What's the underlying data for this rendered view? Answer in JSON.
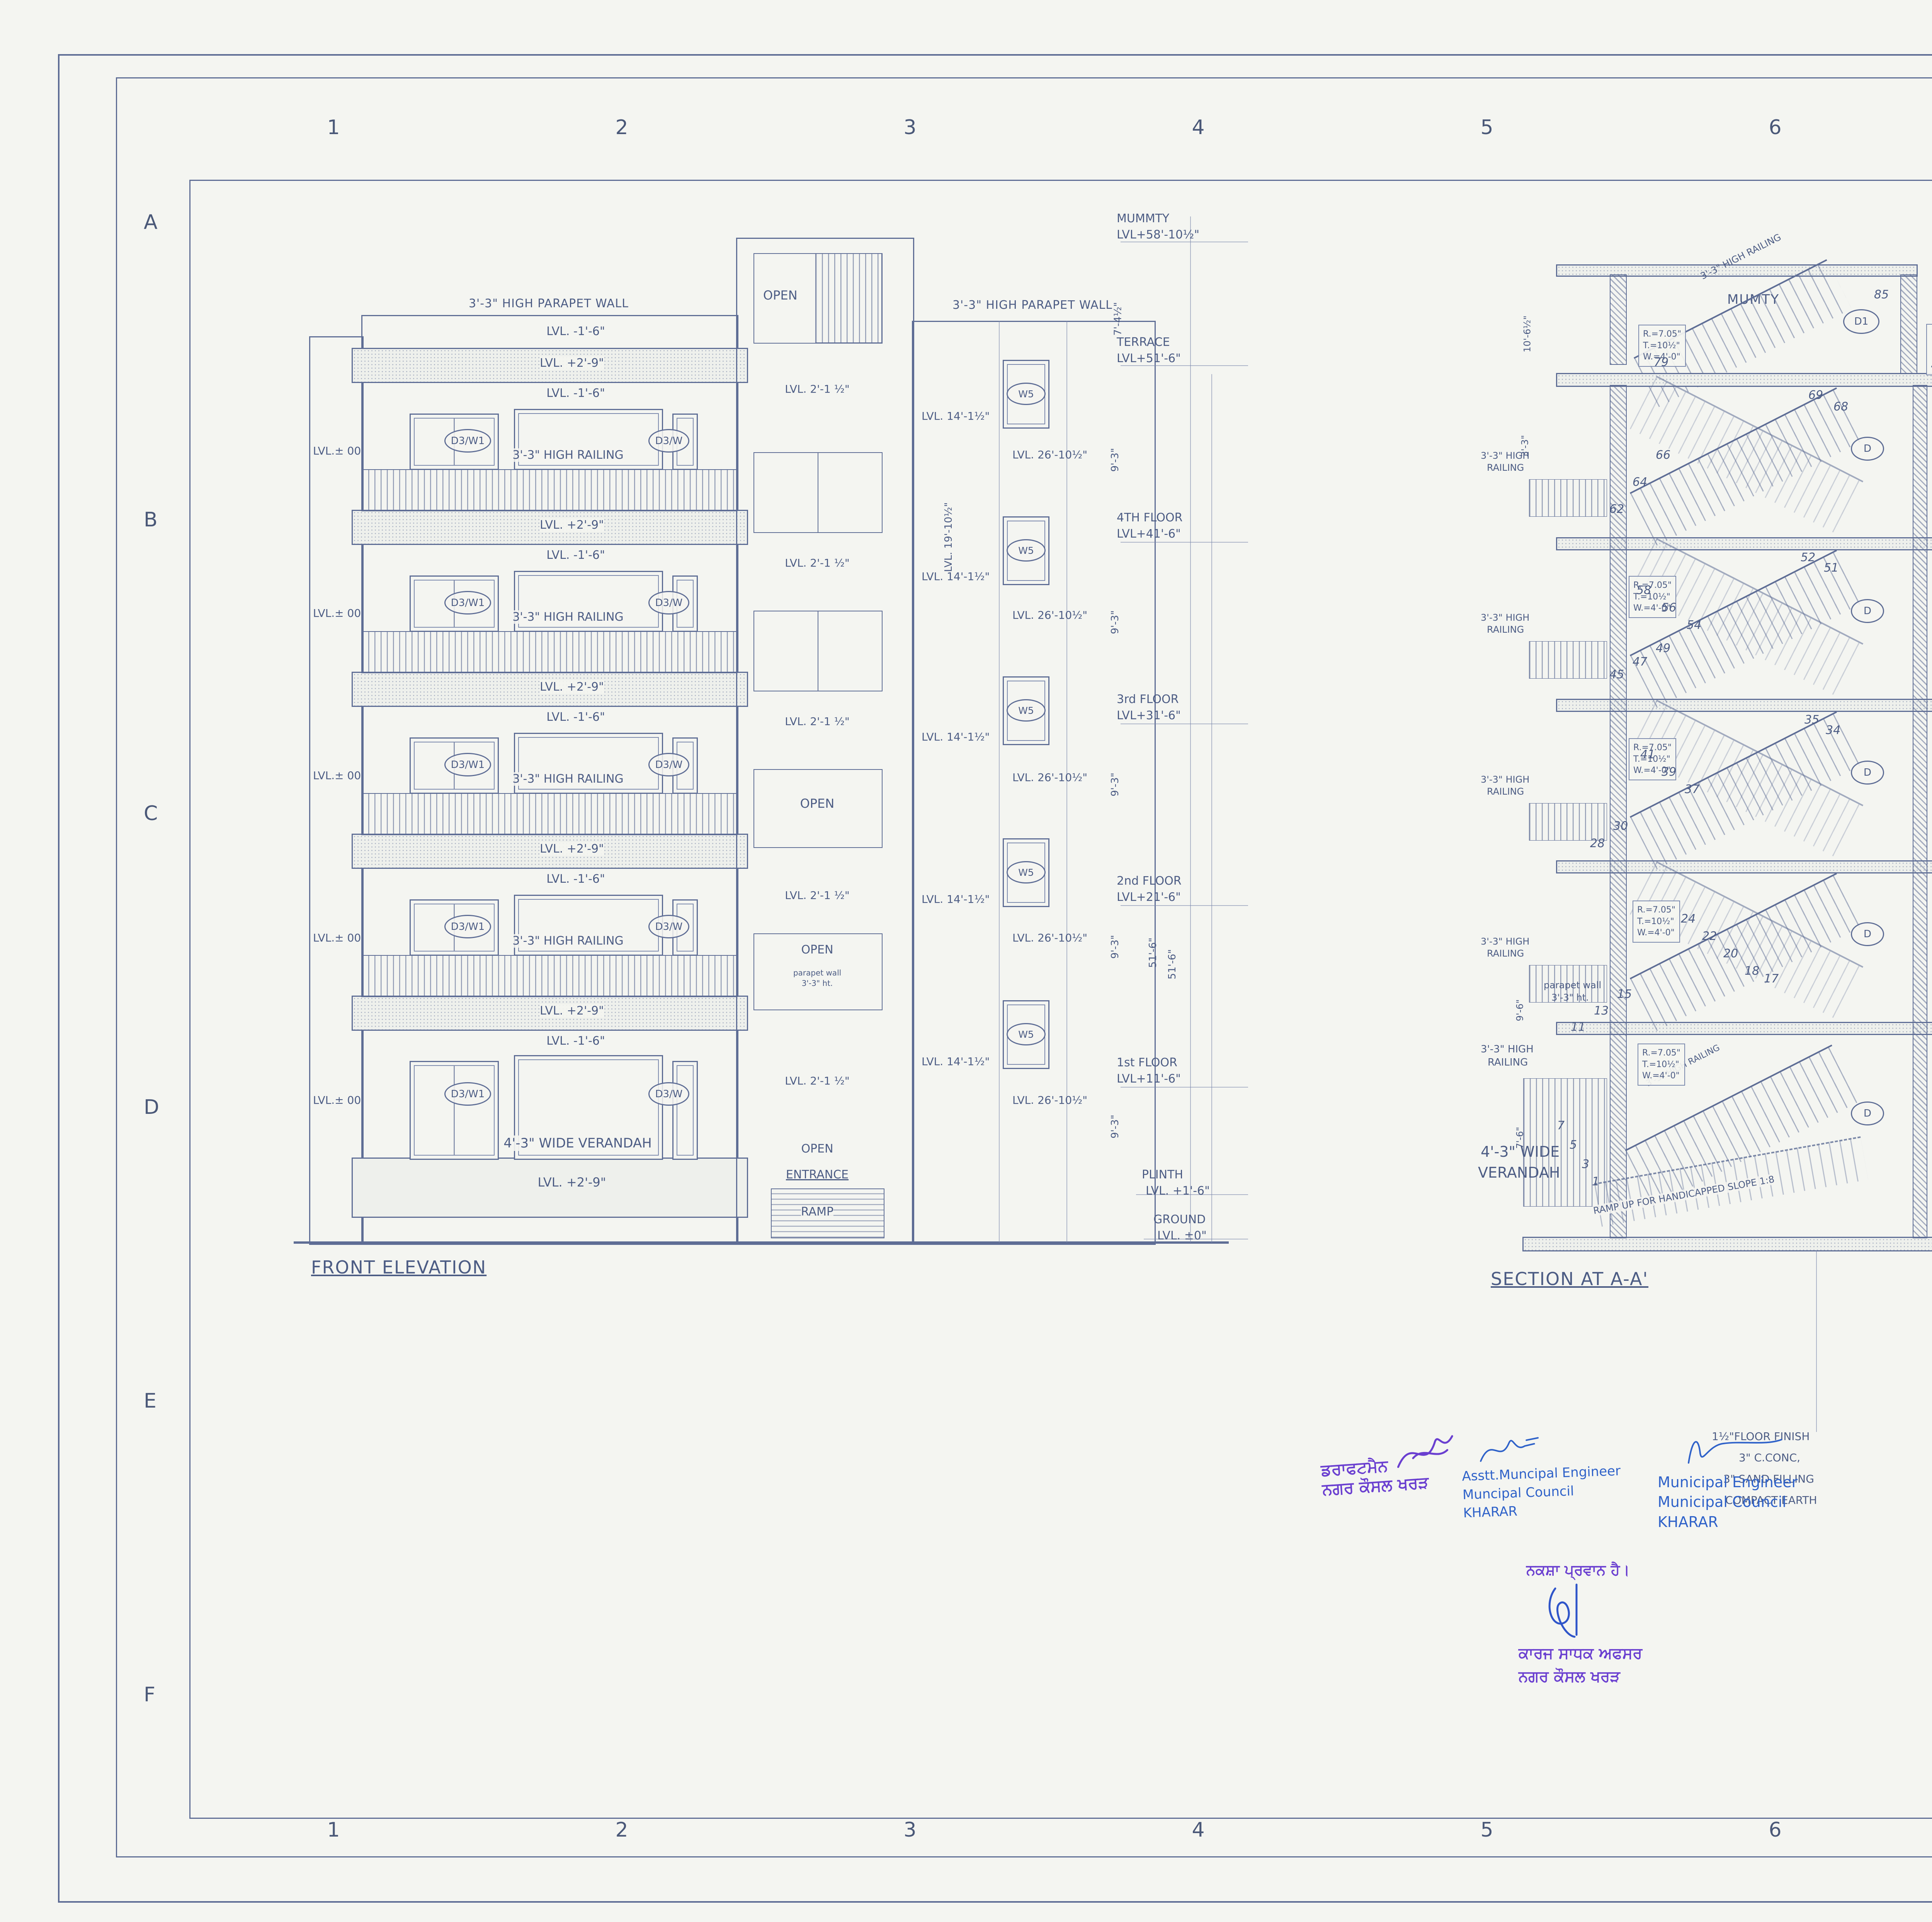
{
  "sheet": {
    "grid_numbers": [
      "1",
      "2",
      "3",
      "4",
      "5",
      "6",
      "7",
      "8"
    ],
    "grid_letters": [
      "A",
      "B",
      "C",
      "D",
      "E",
      "F"
    ],
    "handwritten_number": "6",
    "ink_color": "#5e6d95",
    "stamp_blue": "#2f62c9",
    "stamp_purple": "#6a3fd0"
  },
  "front_elevation": {
    "title": "FRONT ELEVATION",
    "parapet_wall": "3'-3\" HIGH PARAPET WALL",
    "lvl_m16": "LVL.  -1'-6\"",
    "lvl_p29": "LVL. +2'-9\"",
    "lvl_00": "LVL.± 00",
    "railing": "3'-3\" HIGH RAILING",
    "window_tag_left": "D3/W1",
    "window_tag_right": "D3/W",
    "verandah": "4'-3\" WIDE VERANDAH"
  },
  "tower": {
    "open": "OPEN",
    "lvl_2_1": "LVL. 2'-1 ½\"",
    "parapet_note_l1": "parapet wall",
    "parapet_note_l2": "3'-3\" ht.",
    "entrance": "ENTRANCE",
    "ramp": "RAMP"
  },
  "ws_strip": {
    "parapet_wall": "3'-3\" HIGH PARAPET WALL",
    "lvl14": "LVL. 14'-1½\"",
    "lvl19": "LVL. 19'-10½\"",
    "w5": "W5",
    "lvl26": "LVL. 26'-10½\""
  },
  "levels": {
    "mummty_1": "MUMMTY",
    "mummty_2": "LVL+58'-10½\"",
    "terrace_1": "TERRACE",
    "terrace_2": "LVL+51'-6\"",
    "f4_1": "4TH FLOOR",
    "f4_2": "LVL+41'-6\"",
    "f3_1": "3rd FLOOR",
    "f3_2": "LVL+31'-6\"",
    "f2_1": "2nd FLOOR",
    "f2_2": "LVL+21'-6\"",
    "f1_1": "1st FLOOR",
    "f1_2": "LVL+11'-6\"",
    "plinth_1": "PLINTH",
    "plinth_2": "LVL. +1'-6\"",
    "ground_1": "GROUND",
    "ground_2": "LVL. ±0\"",
    "dim_top": "7'-4½\"",
    "dim_floor": "9'-3\"",
    "dim_total": "51'-6\"",
    "dim_slab": "9\""
  },
  "section": {
    "title": "SECTION AT A-A'",
    "mumty": "MUMTY",
    "parapet_wall": "3'-3\" HIGH PARAPET WALL",
    "d1": "D1",
    "d": "D",
    "d2": "D2",
    "cb": "CB.",
    "bedroom": "BED ROOM-03",
    "toilet": "TOILET-03",
    "sunken": "SUNKEN",
    "verandah_l1": "4'-3\" WIDE",
    "verandah_l2": "VERANDAH",
    "ramp_note": "RAMP UP FOR HANDICAPPED SLOPE 1:8",
    "railing_diag": "3'-3\" HIGH RAILING",
    "high_railing_l1": "3'-3\" HIGH",
    "high_railing_l2": "RAILING",
    "stair_note_1": "R.=7.05\"",
    "stair_note_2": "T.=10½\"",
    "stair_note_3": "W.=4'-0\"",
    "terrace_note_1": "1 1/2\" TILE TERRACING",
    "terrace_note_2": "3\" MUD PHUSKA LAID TO SLOPE",
    "terrace_note_3": "2 COATS OF HOT BITUMEN",
    "terrace_note_4": "4 1/2\" THK R.C.C. SLAB AS/STR DRG.",
    "floor_note_1": "1½\" FLOOR FINISHING",
    "floor_note_2": "3\" C. CONC.",
    "floor_note_3": "4½\" THK. R.C.C. SLAB",
    "floor_note_4": "AS/STRUCTURE DESIGN",
    "ground_note_1": "1½\"FLOOR FINISH",
    "ground_note_2": "3\" C.CONC,",
    "ground_note_3": "3\" SAND FILLING",
    "ground_note_4": "COMPACT EARTH",
    "parapet_note_l1": "parapet wall",
    "parapet_note_l2": "3'-3\" ht.",
    "dim_10_6": "10'-6½\"",
    "dim_3_3": "3'-3\"",
    "dim_9_6": "9'-6\"",
    "dim_7_6": "7'-6\"",
    "steps": [
      "85",
      "79",
      "69",
      "68",
      "66",
      "64",
      "62",
      "58",
      "56",
      "54",
      "52",
      "51",
      "49",
      "47",
      "45",
      "41",
      "39",
      "37",
      "35",
      "34",
      "30",
      "28",
      "24",
      "22",
      "20",
      "18",
      "17",
      "15",
      "13",
      "11",
      "7",
      "5",
      "3",
      "1"
    ]
  },
  "stamps": {
    "draftsman_l1": "ਡਰਾਫਟਮੈਨ",
    "draftsman_l2": "ਨਗਰ ਕੌਸਲ ਖਰੜ",
    "asst_1": "Asstt.Muncipal Engineer",
    "asst_2": "Muncipal Council",
    "asst_3": "KHARAR",
    "mun_1": "Municipal Engineer",
    "mun_2": "Municipal Council",
    "mun_3": "KHARAR",
    "approved_pa": "ਨਕਸ਼ਾ ਪ੍ਰਵਾਨ ਹੈ।",
    "officer_l1": "ਕਾਰਜ ਸਾਧਕ ਅਫਸਰ",
    "officer_l2": "ਨਗਰ ਕੌਸਲ ਖਰੜ"
  },
  "title_block": {
    "project_label": "PROJECT:-",
    "project_1": "PROPOSED GROUP HOUSING FOR",
    "project_2": "GURPREET DEVELOPER & PROMOTORS PT.LTD.",
    "project_3a": "ARCADIA-",
    "project_3b": "\"PARK EAST\"",
    "project_4": "AT KHARAR ,LUDHIANA ROAD KHARAR.",
    "promoters_label": "PROMOTERS:-",
    "promoters_1": "M/S PRIMARY ESTATES & DEVELOPERS PVT.LT.",
    "promoters_2": "SCO NO.43 GROUND FLOOR BRHIND KFC",
    "promoters_3": "NEW SUNNY ENCLAVE,SECTOR - 125",
    "promoters_4": "SAS NAGAR MOHALI PUNJAB.",
    "title_label": "TITLE:",
    "title_1": "SECTION AND FRONT ELEVATION",
    "title_2": "(BLOCK-02, G+4 FLOOR)",
    "architect_label": "ARCHITECT :-",
    "architect_name": "Ar. Umesh Sharma",
    "architect_reg": "CA/2017/84816",
    "owner_label": "OWNER:-",
    "owner_stamp": "Primary Estates & Developers Pvt. Ltd.",
    "owner_caption": "Authorized Signatory",
    "architects_label": "ARCHITECTS :",
    "firm": "The Design Studio",
    "firm_sub": "ARCHITECT'S,INTERIOR  DESIGNERS  & Turnkey projects",
    "firm_addr1": "SCO 230-231, 3rd FLOOR , SEC. 34-A,",
    "firm_addr2": "CHANDIGARH. Ph. -0172-5016372",
    "approved": "Approved",
    "drawn": "DRAWN:",
    "date": "Date:",
    "disclaimer_1": "THIS DRAWING IS THE PROPERTY OF THE CONSULTANTS. NO PART OF THIS",
    "disclaimer_2": "SHALL BE USED, COPIED OR REPRODUCED WITHOUT THEIR WRITTEN PERMISSION"
  }
}
